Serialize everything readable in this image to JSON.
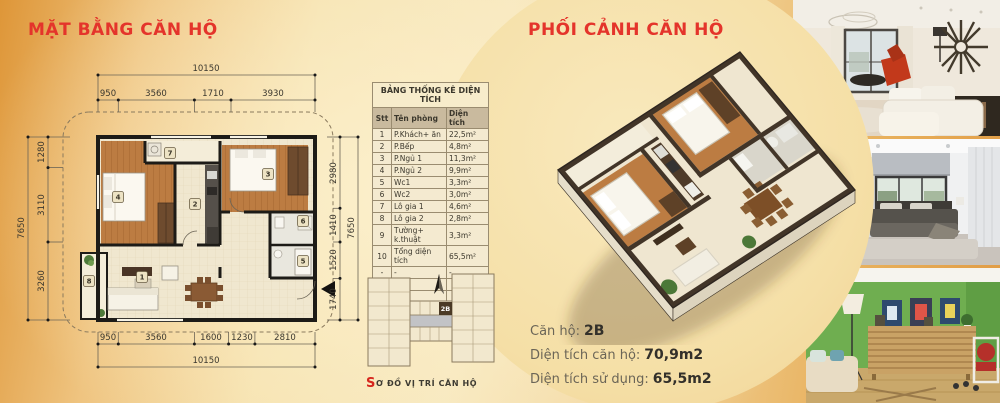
{
  "titles": {
    "plan": "MẶT BẰNG CĂN HỘ",
    "perspective": "PHỐI CẢNH CĂN HỘ"
  },
  "area_table": {
    "title": "BẢNG THỐNG KÊ DIỆN TÍCH",
    "columns": [
      "Stt",
      "Tên phòng",
      "Diện tích"
    ],
    "rows": [
      [
        "1",
        "P.Khách+ ăn",
        "22,5m²"
      ],
      [
        "2",
        "P.Bếp",
        "4,8m²"
      ],
      [
        "3",
        "P.Ngủ 1",
        "11,3m²"
      ],
      [
        "4",
        "P.Ngủ 2",
        "9,9m²"
      ],
      [
        "5",
        "Wc1",
        "3,3m²"
      ],
      [
        "6",
        "Wc2",
        "3,0m²"
      ],
      [
        "7",
        "Lô gia 1",
        "4,6m²"
      ],
      [
        "8",
        "Lô gia 2",
        "2,8m²"
      ],
      [
        "9",
        "Tường+ k.thuật",
        "3,3m²"
      ],
      [
        "10",
        "Tổng diện tích",
        "65,5m²"
      ],
      [
        "-",
        "-",
        "-"
      ]
    ],
    "empty_rows": 2
  },
  "floor_plan": {
    "dims": {
      "top_total": "10150",
      "top_segments": [
        "950",
        "3560",
        "1710",
        "3930"
      ],
      "bottom_segments": [
        "950",
        "3560",
        "1600",
        "1230",
        "2810"
      ],
      "bottom_total": "10150",
      "left_segments": [
        "1280",
        "3110",
        "3260"
      ],
      "left_total": "7650",
      "right_segments": [
        "2980",
        "1410",
        "1520",
        "1740"
      ],
      "right_total": "7650"
    },
    "room_numbers": [
      "1",
      "2",
      "3",
      "4",
      "5",
      "6",
      "7",
      "8"
    ]
  },
  "location_diagram": {
    "unit_badge": "2B",
    "caption_initial": "S",
    "caption_rest": "Ơ ĐỒ VỊ TRÍ CĂN HỘ"
  },
  "perspective_info": {
    "unit_label": "Căn hộ:",
    "unit_value": "2B",
    "area_label": "Diện tích căn hộ:",
    "area_value": "70,9m2",
    "use_label": "Diện tích sử dụng:",
    "use_value": "65,5m2"
  },
  "colors": {
    "accent_red": "#E4342B",
    "bg_orange": "#E29A43",
    "bg_cream": "#F8E9C0",
    "circle": "#F5E0A8",
    "wall_dark": "#1D1B17",
    "wood": "#BC7C42"
  }
}
